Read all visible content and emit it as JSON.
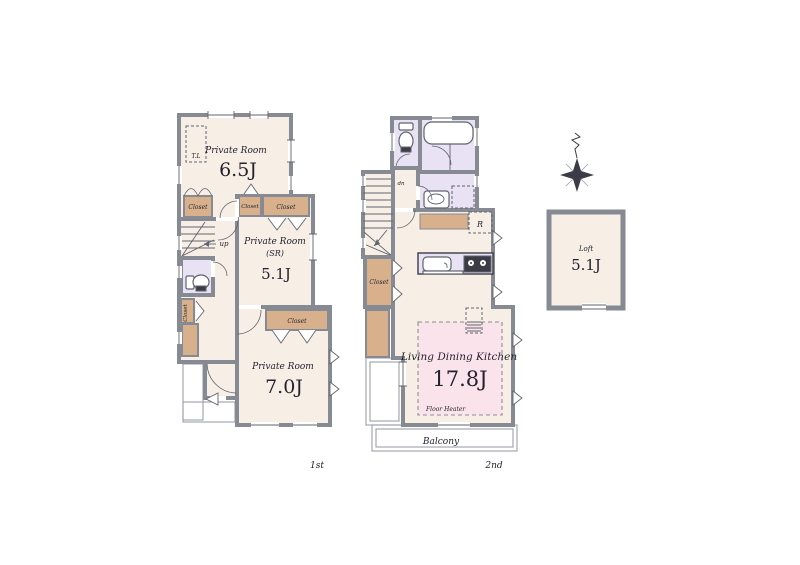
{
  "colors": {
    "wall": "#868a92",
    "room": "#f7efe6",
    "closet": "#d8b18c",
    "wet": "#e9e1f4",
    "heater": "#fbe3eb",
    "line": "#60646d",
    "thin": "#9aa0a8",
    "text": "#23232e",
    "dark": "#3c3c46"
  },
  "labels": {
    "closet": "Closet",
    "up": "up",
    "dn": "dn",
    "tl": "T.L",
    "refrigerator": "R",
    "floor_heater": "Floor Heater",
    "balcony": "Balcony",
    "first_floor": "1st",
    "second_floor": "2nd"
  },
  "rooms": {
    "room_65": {
      "name": "Private Room",
      "size": "6.5J"
    },
    "room_51": {
      "name": "Private Room",
      "sub": "(SR)",
      "size": "5.1J"
    },
    "room_70": {
      "name": "Private Room",
      "size": "7.0J"
    },
    "ldk": {
      "name": "Living Dining Kitchen",
      "size": "17.8J"
    },
    "loft": {
      "name": "Loft",
      "size": "5.1J"
    }
  }
}
